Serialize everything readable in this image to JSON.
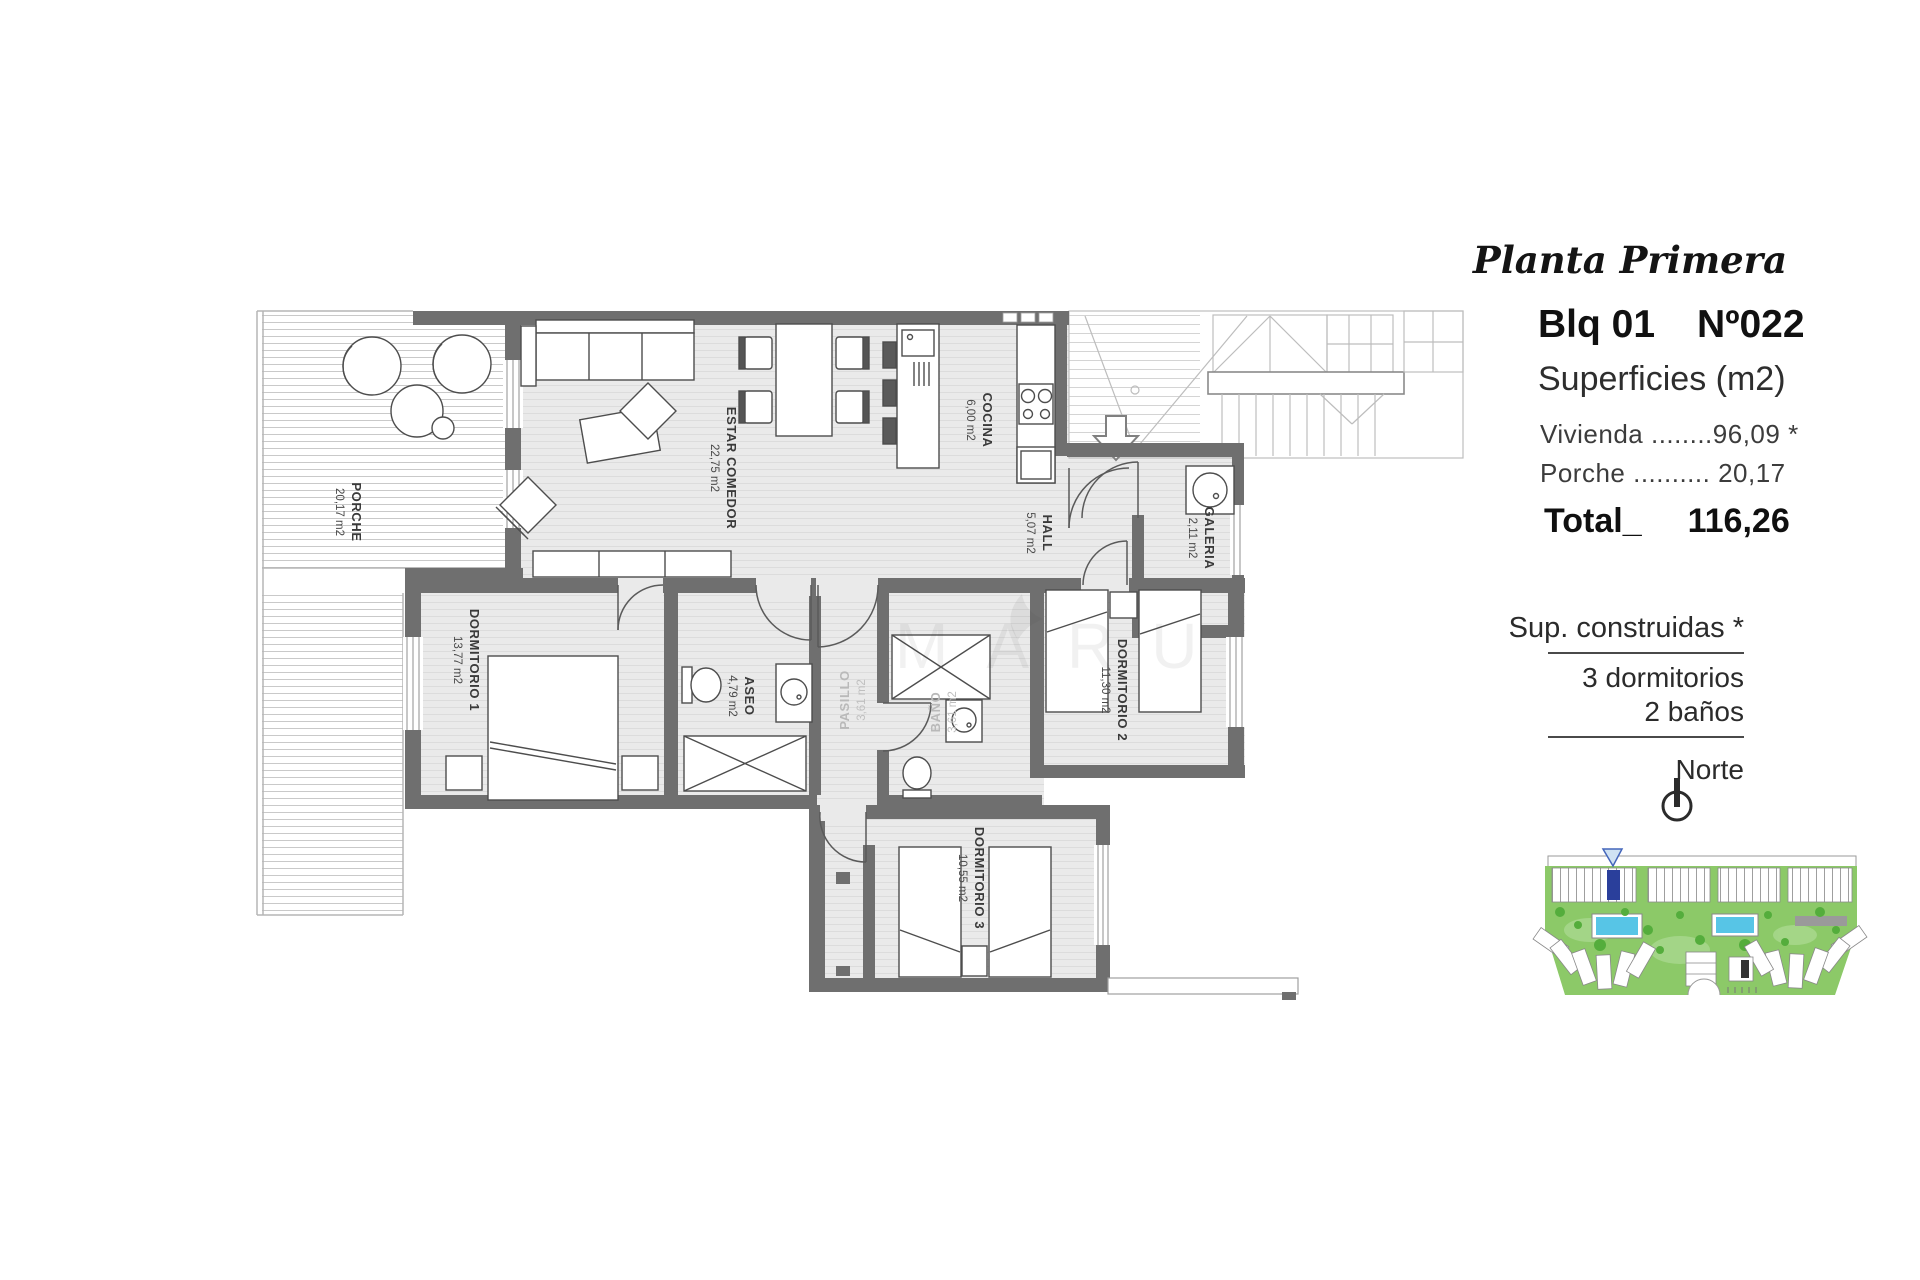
{
  "panel": {
    "plan_title": "Planta Primera",
    "block": "Blq 01",
    "unit_number": "Nº022",
    "surfaces_heading": "Superficies (m2)",
    "vivienda_line": "Vivienda ........96,09 *",
    "porche_line": "Porche .......... 20,17",
    "total_label": "Total_",
    "total_value": "116,26",
    "sup_heading": "Sup. construidas *",
    "dormitorios": "3 dormitorios",
    "banos": "2 baños",
    "north_label": "Norte"
  },
  "rooms": [
    {
      "name": "PORCHE",
      "area": "20,17 m2"
    },
    {
      "name": "ESTAR COMEDOR",
      "area": "22,75 m2"
    },
    {
      "name": "COCINA",
      "area": "6,00 m2"
    },
    {
      "name": "HALL",
      "area": "5,07 m2"
    },
    {
      "name": "GALERIA",
      "area": "2,11 m2"
    },
    {
      "name": "DORMITORIO 1",
      "area": "13,77 m2"
    },
    {
      "name": "ASEO",
      "area": "4,79 m2"
    },
    {
      "name": "PASILLO",
      "area": "3,61 m2"
    },
    {
      "name": "BAÑO",
      "area": "3,61 m2"
    },
    {
      "name": "DORMITORIO 2",
      "area": "11,30 m2"
    },
    {
      "name": "DORMITORIO 3",
      "area": "10,55 m2"
    }
  ],
  "watermark": "MARU",
  "colors": {
    "wall": "#6f6f6f",
    "site_green": "#8cc968",
    "tree_green": "#54ad3c",
    "pool_blue": "#57c5e6",
    "highlight_unit": "#2a3f9b"
  }
}
